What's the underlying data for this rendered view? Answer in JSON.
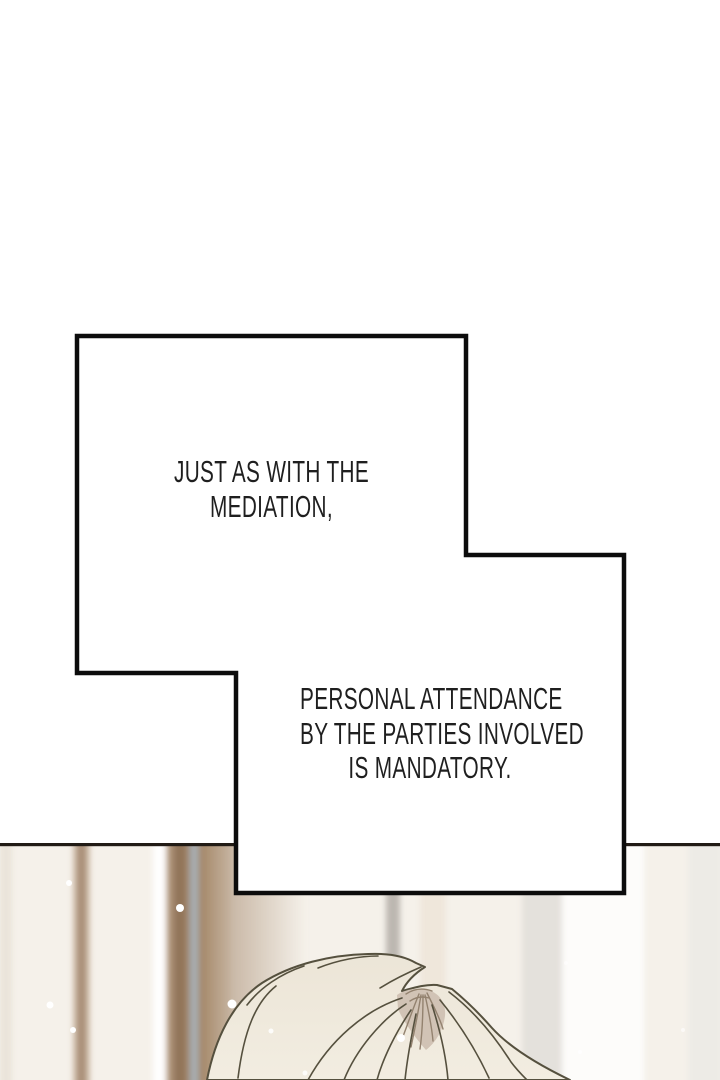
{
  "dialogue": {
    "bubble1": {
      "lines": [
        "JUST AS WITH THE",
        "MEDIATION,"
      ]
    },
    "bubble2": {
      "lines": [
        "PERSONAL ATTENDANCE",
        "BY THE PARTIES INVOLVED",
        "IS MANDATORY."
      ]
    }
  },
  "colors": {
    "page_background": "#ffffff",
    "bubble_border": "#0c0c0c",
    "bubble_fill": "#ffffff",
    "dialogue_text": "#1f1f1f",
    "scene_base": "#f5f1ea",
    "scene_top_line": "#211b15",
    "stripe_brown": "#9c8066",
    "stripe_gray_blue": "#9aa0a3",
    "hair_fill": "#ece5d7",
    "hair_outline": "#55503e",
    "hair_whorl": "#d1c3b5",
    "whorl_stroke": "#93826f",
    "sparkle": "#ffffff"
  }
}
